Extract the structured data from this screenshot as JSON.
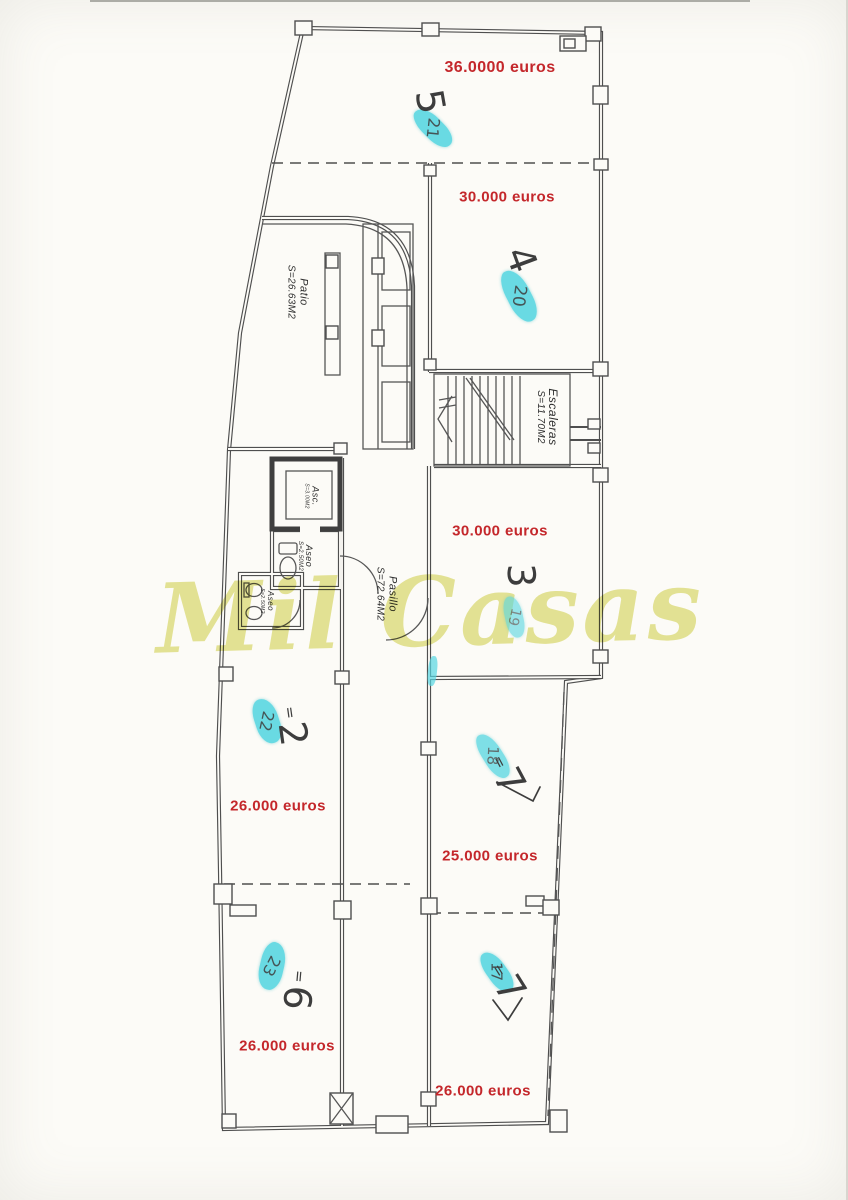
{
  "watermark": {
    "text": "Mil Casas"
  },
  "colors": {
    "price_red": "#c4272b",
    "highlight_cyan": "#55d6e1",
    "watermark_yellow": "#e4e493",
    "plan_ink": "#4f4f4f"
  },
  "plan_labels": {
    "patio": {
      "name": "Patio",
      "area": "S=26.63M2"
    },
    "escaleras": {
      "name": "Escaleras",
      "area": "S=11.70M2"
    },
    "pasillo": {
      "name": "Pasillo",
      "area": "S=72.64M2"
    },
    "ascensor": {
      "name": "Asc.",
      "area": "S=3.00M2"
    },
    "aseo_upper": {
      "name": "Aseo",
      "area": "S=2.50M2"
    },
    "aseo_lower": {
      "name": "Aseo",
      "area": "S=2.50M2"
    }
  },
  "units": [
    {
      "room": "5",
      "price": "36.0000 euros",
      "eq": "",
      "digit": "5",
      "tag": "21"
    },
    {
      "room": "4",
      "price": "30.000 euros",
      "eq": "",
      "digit": "4",
      "tag": "20"
    },
    {
      "room": "3",
      "price": "30.000 euros",
      "eq": "",
      "digit": "3",
      "tag": "19"
    },
    {
      "room": "2",
      "price": "26.000 euros",
      "eq": "=",
      "digit": "2",
      "tag": "22"
    },
    {
      "room": "18",
      "price": "25.000 euros",
      "eq": "=",
      "digit": "7",
      "tag": "18"
    },
    {
      "room": "6",
      "price": "26.000 euros",
      "eq": "=",
      "digit": "6",
      "tag": "23"
    },
    {
      "room": "7",
      "price": "26.000 euros",
      "eq": "=",
      "digit": "7",
      "tag": "17"
    }
  ]
}
